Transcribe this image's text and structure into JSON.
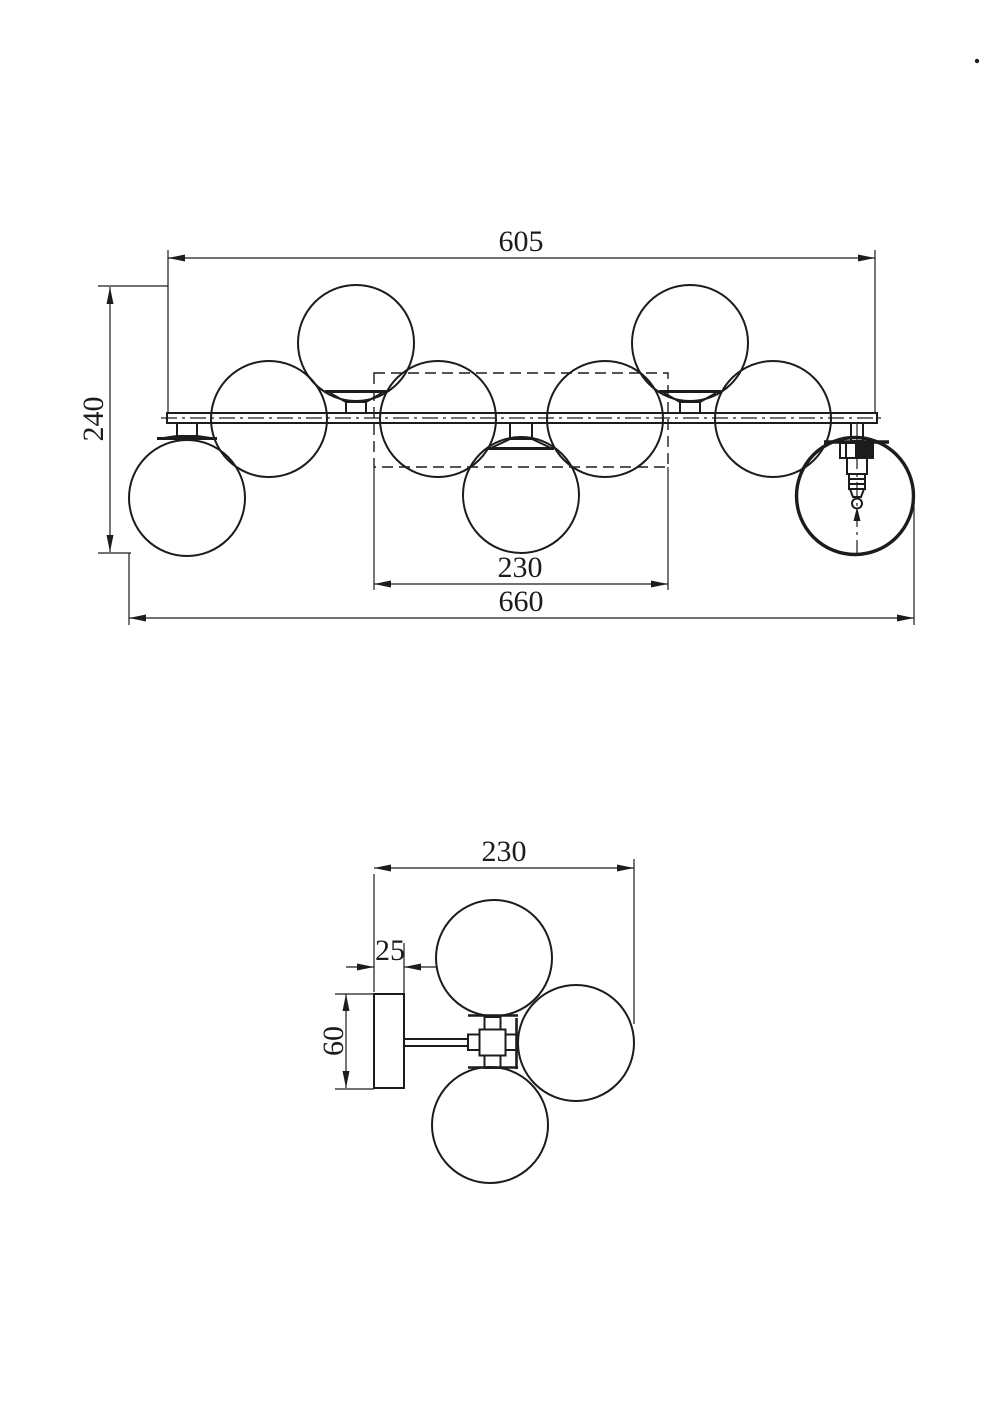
{
  "page": {
    "background": "#ffffff",
    "ink": "#1c1c1c"
  },
  "front_view": {
    "dim_bar_length": "605",
    "dim_total_height": "240",
    "dim_module_width": "230",
    "dim_total_length": "660"
  },
  "side_view": {
    "dim_depth": "230",
    "dim_plate_thickness": "25",
    "dim_plate_height": "60"
  }
}
